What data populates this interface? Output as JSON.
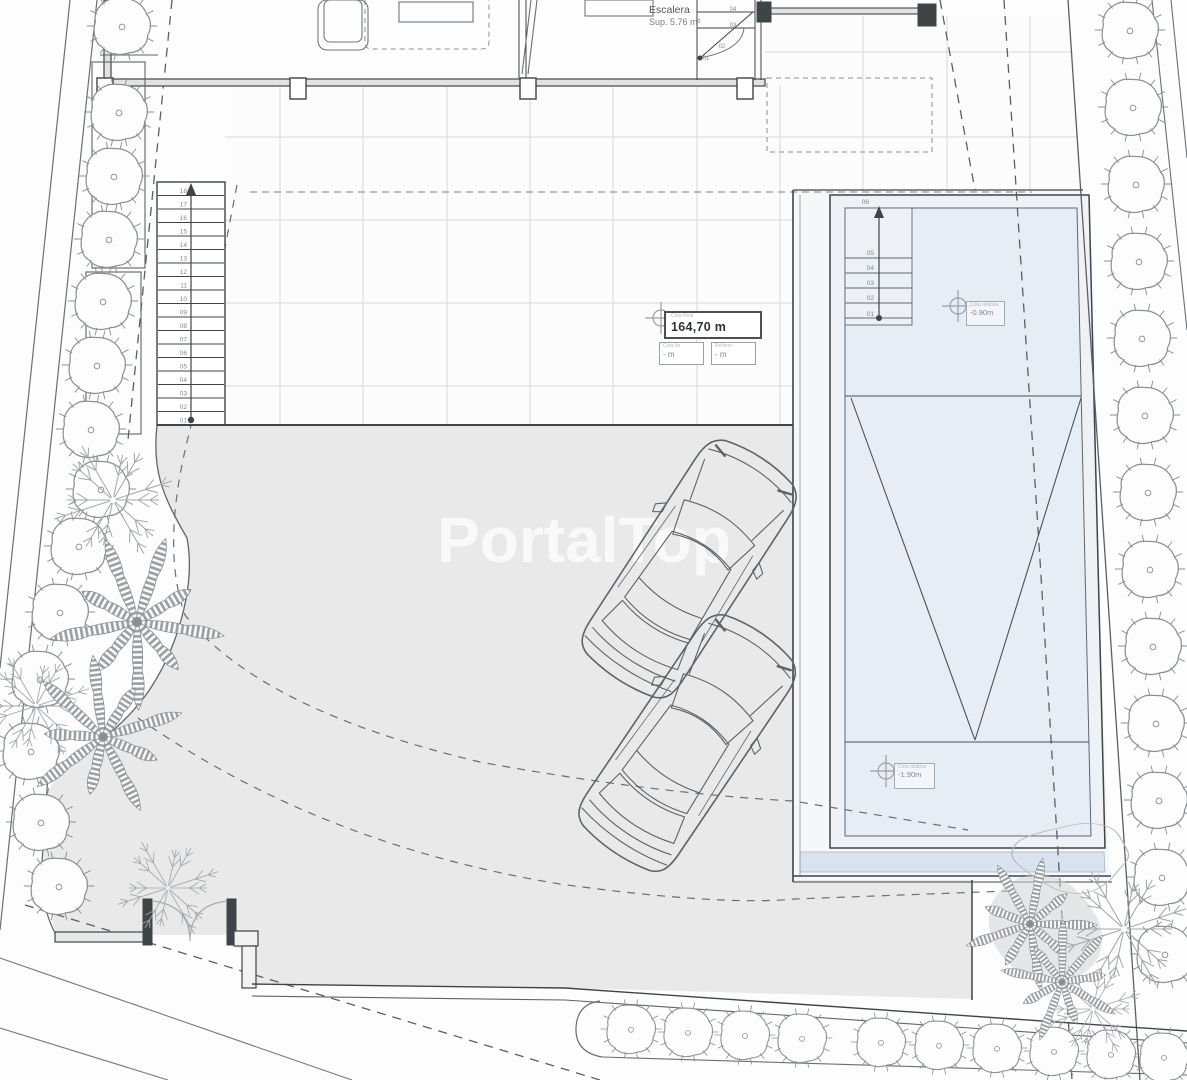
{
  "watermark": "PortalTop",
  "labels": {
    "escalera_title": "Escalera",
    "escalera_area": "Sup. 5.76 m²",
    "area_table": {
      "header": "Cota Real",
      "value": "164,70 m",
      "col1_label": "Cota fin",
      "col1_value": "- m",
      "col2_label": "Relleno",
      "col2_value": "- m"
    },
    "marker_pool_top": {
      "header": "Cota relativa",
      "value": "-0.90m"
    },
    "marker_pool_bottom": {
      "header": "Cota relativa",
      "value": "-1.90m"
    }
  },
  "stairs": {
    "main_numbers": [
      "18",
      "17",
      "16",
      "15",
      "14",
      "13",
      "12",
      "11",
      "10",
      "09",
      "08",
      "07",
      "06",
      "05",
      "04",
      "03",
      "02",
      "01"
    ],
    "pool_numbers": [
      "06",
      "05",
      "04",
      "03",
      "02",
      "01"
    ],
    "entry_numbers": [
      "04",
      "03",
      "02",
      "01"
    ]
  },
  "colors": {
    "driveway": "#e9e9e9",
    "terrace": "#fcfcfc",
    "pool_water": "#e7edf4",
    "pool_deck": "#f5f7f9",
    "pool_enclosure": "#eef2f7",
    "pool_band": "#d9e2ee",
    "wall_dark": "#3f4447",
    "line_medium": "#8a9095",
    "grid": "#d8d8d8",
    "vegetation": "#979ca0",
    "watermark": "rgba(255,255,255,0.72)"
  }
}
